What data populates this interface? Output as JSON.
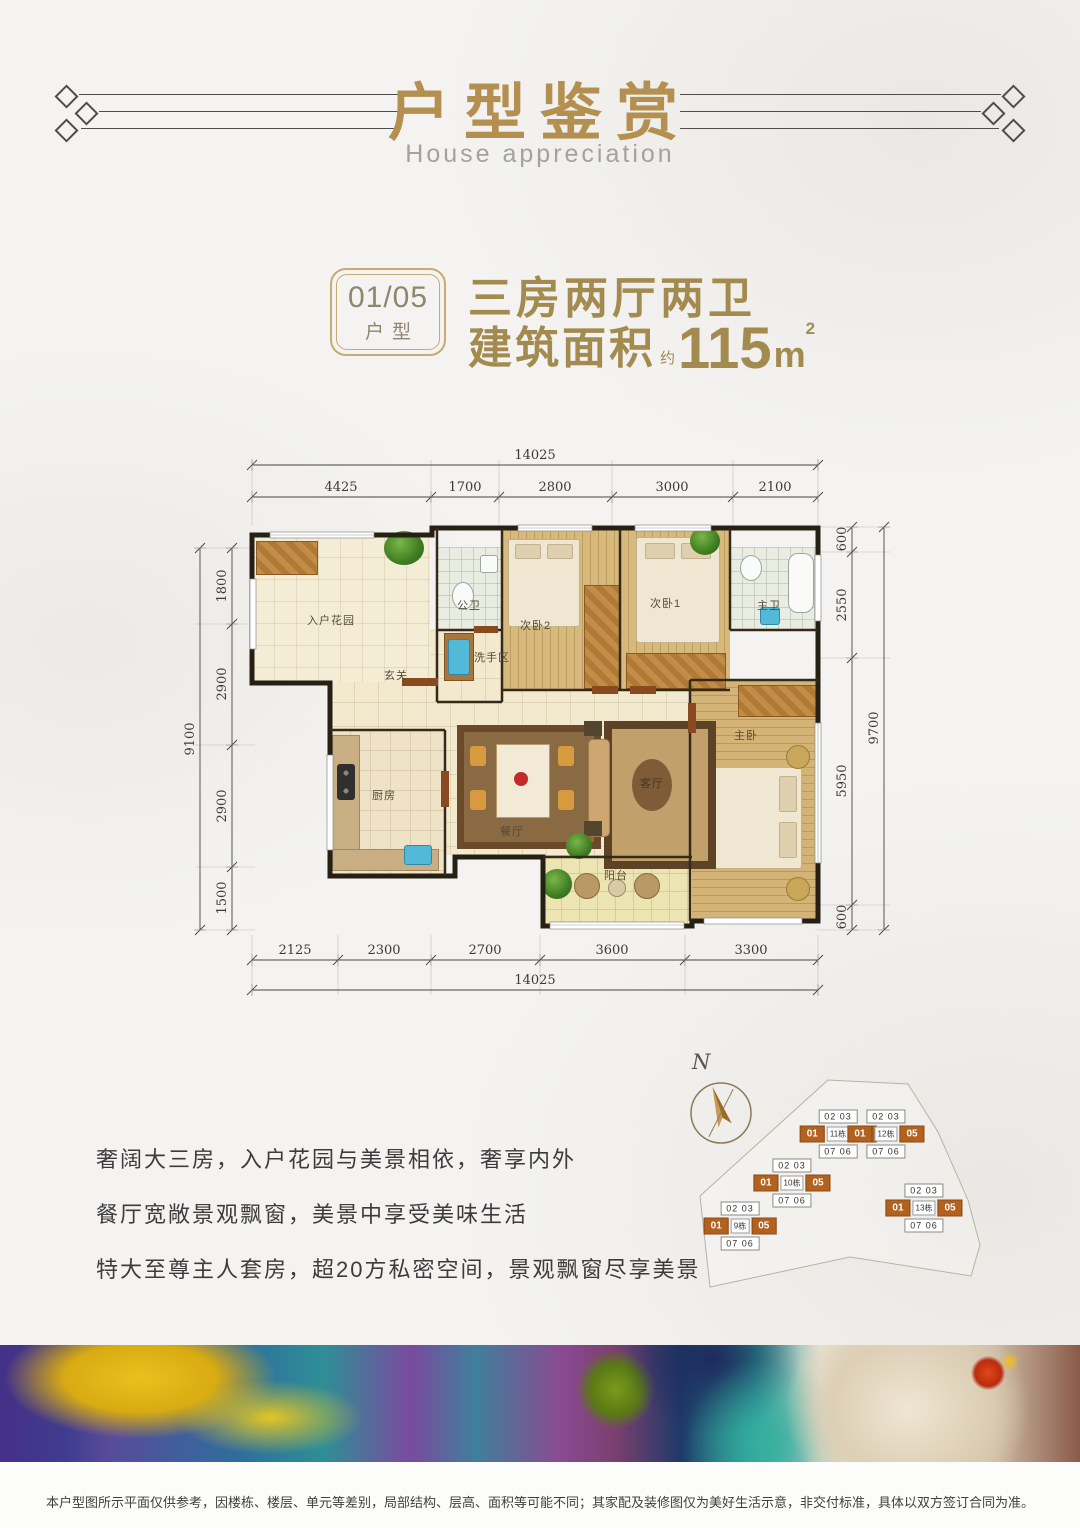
{
  "header": {
    "title": "户型鉴赏",
    "subtitle": "House appreciation"
  },
  "unit_info": {
    "badge_top": "01/05",
    "badge_bottom": "户型",
    "headline": "三房两厅两卫",
    "area_label": "建筑面积",
    "area_approx": "约",
    "area_value": "115",
    "area_unit_base": "m",
    "area_unit_sup": "2"
  },
  "floor_plan": {
    "dim_top_total": "14025",
    "dim_top_segments": [
      "4425",
      "1700",
      "2800",
      "3000",
      "2100"
    ],
    "dim_left_total": "9100",
    "dim_left_segments": [
      "1800",
      "2900",
      "2900",
      "1500"
    ],
    "dim_right_total": "9700",
    "dim_right_segments": [
      "600",
      "2550",
      "5950",
      "600"
    ],
    "dim_bottom_total": "14025",
    "dim_bottom_segments": [
      "2125",
      "2300",
      "2700",
      "3600",
      "3300"
    ],
    "rooms": {
      "entry_garden": "入户花园",
      "public_bath": "公卫",
      "wash_area": "洗手区",
      "foyer": "玄关",
      "bedroom2": "次卧2",
      "bedroom1": "次卧1",
      "master_bath": "主卫",
      "kitchen": "厨房",
      "dining": "餐厅",
      "living": "客厅",
      "master_bedroom": "主卧",
      "balcony": "阳台"
    }
  },
  "compass": {
    "north": "N"
  },
  "site_plan": {
    "buildings": [
      {
        "number": "9栋",
        "top": "02 03",
        "unit_left": "01",
        "unit_right": "05",
        "bottom": "07 06"
      },
      {
        "number": "10栋",
        "top": "02 03",
        "unit_left": "01",
        "unit_right": "05",
        "bottom": "07 06"
      },
      {
        "number": "11栋",
        "top": "02 03",
        "unit_left": "01",
        "unit_right": "05",
        "bottom": "07 06"
      },
      {
        "number": "12栋",
        "top": "02 03",
        "unit_left": "01",
        "unit_right": "05",
        "bottom": "07 06"
      },
      {
        "number": "13栋",
        "top": "02 03",
        "unit_left": "01",
        "unit_right": "05",
        "bottom": "07 06"
      }
    ]
  },
  "selling_points": [
    "奢阔大三房，入户花园与美景相依，奢享内外",
    "餐厅宽敞景观飘窗，美景中享受美味生活",
    "特大至尊主人套房，超20方私密空间，景观飘窗尽享美景"
  ],
  "disclaimer": "本户型图所示平面仅供参考，因楼栋、楼层、单元等差别，局部结构、层高、面积等可能不同；其家配及装修图仅为美好生活示意，非交付标准，具体以双方签订合同为准。",
  "colors": {
    "accent_gold": "#b3904f",
    "highlight_orange": "#b2611f",
    "wall": "#262014"
  }
}
